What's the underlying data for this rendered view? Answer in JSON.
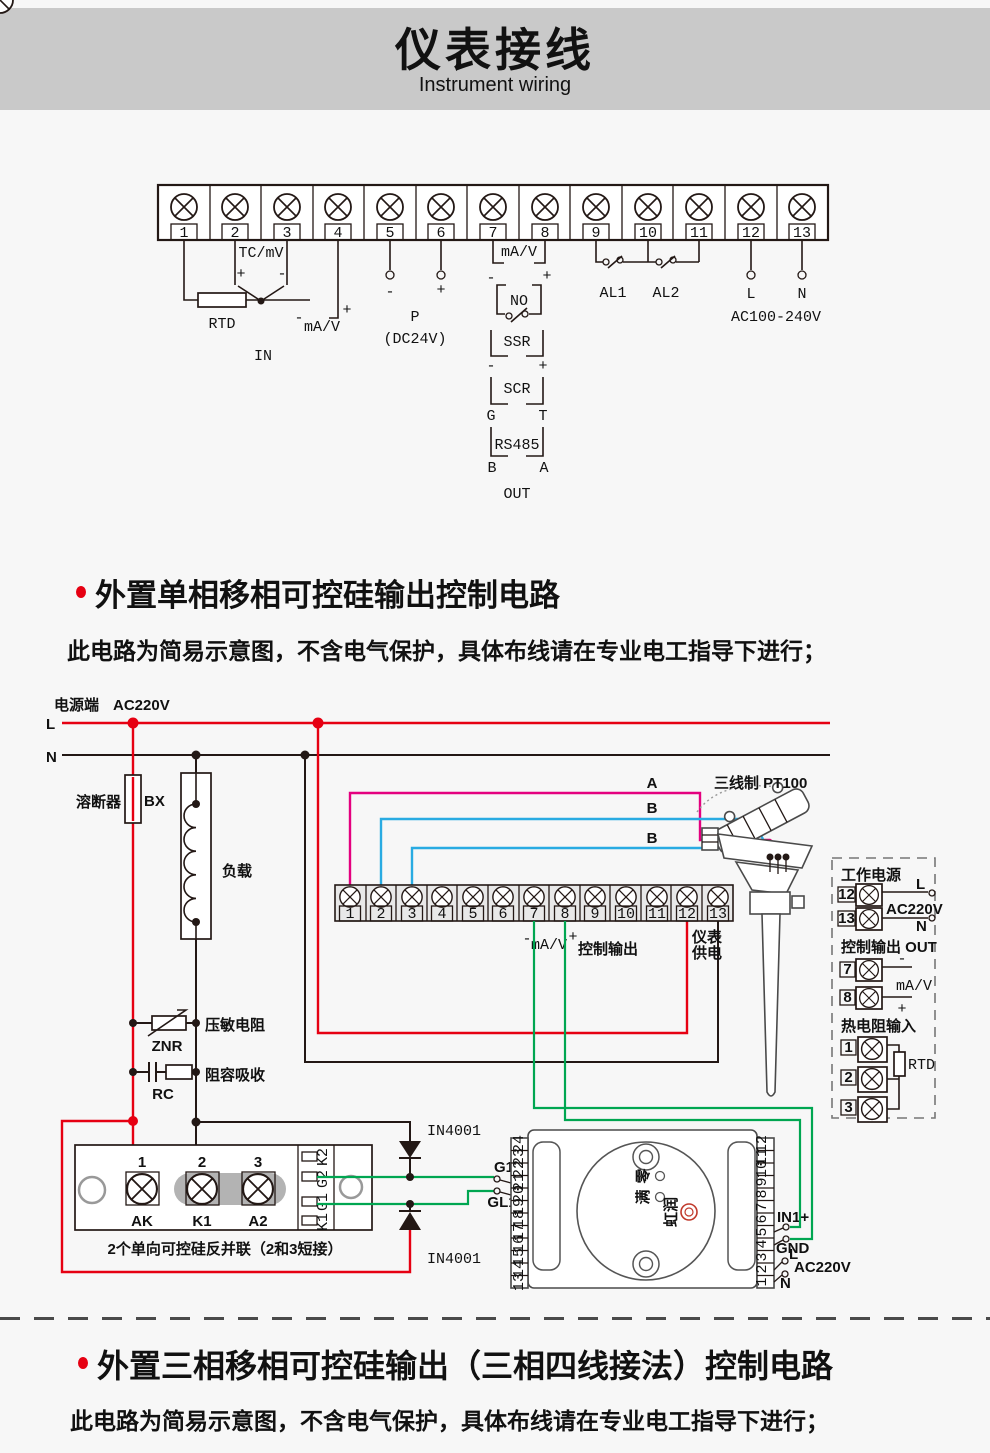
{
  "header": {
    "title": "仪表接线",
    "subtitle": "Instrument wiring"
  },
  "top_diagram": {
    "terminal_numbers": [
      "1",
      "2",
      "3",
      "4",
      "5",
      "6",
      "7",
      "8",
      "9",
      "10",
      "11",
      "12",
      "13"
    ],
    "rtd": "RTD",
    "tc": "TC/mV",
    "tc_plus": "+",
    "tc_minus": "-",
    "in_minus": "-",
    "in_mav": "mA/V",
    "in_plus": "+",
    "in": "IN",
    "p_minus": "-",
    "p_plus": "+",
    "p": "P",
    "p_volt": "(DC24V)",
    "out_mav": "mA/V",
    "out_minus": "-",
    "out_plus": "+",
    "no": "NO",
    "ssr": "SSR",
    "ssr_minus": "-",
    "ssr_plus": "+",
    "scr": "SCR",
    "scr_g": "G",
    "scr_t": "T",
    "rs485": "RS485",
    "rs485_b": "B",
    "rs485_a": "A",
    "out": "OUT",
    "al1": "AL1",
    "al2": "AL2",
    "l": "L",
    "n": "N",
    "mains": "AC100-240V"
  },
  "section1": {
    "title": "外置单相移相可控硅输出控制电路",
    "note": "此电路为简易示意图，不含电气保护，具体布线请在专业电工指导下进行；"
  },
  "circuit": {
    "source": "电源端",
    "source_voltage": "AC220V",
    "l": "L",
    "n": "N",
    "fuse": "溶断器",
    "fuse_code": "BX",
    "load": "负载",
    "varistor": "压敏电阻",
    "varistor_code": "ZNR",
    "snubber": "阻容吸收",
    "snubber_code": "RC",
    "sensor": "三线制 PT100",
    "wire_a": "A",
    "wire_b1": "B",
    "wire_b2": "B",
    "strip_numbers": [
      "1",
      "2",
      "3",
      "4",
      "5",
      "6",
      "7",
      "8",
      "9",
      "10",
      "11",
      "12",
      "13"
    ],
    "ctrl_minus": "-",
    "ctrl_mav": "mA/V",
    "ctrl_plus": "+",
    "ctrl_label": "控制输出",
    "supply1": "仪表",
    "supply2": "供电",
    "module": {
      "n1": "1",
      "n2": "2",
      "n3": "3",
      "ak": "AK",
      "k1": "K1",
      "a2": "A2",
      "pins": [
        "K2",
        "G2",
        "G1",
        "K1"
      ],
      "caption": "2个单向可控硅反并联（2和3短接）"
    },
    "diode_top": "IN4001",
    "diode_bottom": "IN4001",
    "g1": "G1",
    "gl1": "GL1",
    "meter": {
      "left_terminals": [
        "24",
        "23",
        "22",
        "21",
        "20",
        "19",
        "18",
        "17",
        "16",
        "15",
        "14",
        "13"
      ],
      "right_terminals": [
        "12",
        "11",
        "10",
        "9",
        "8",
        "7",
        "6",
        "5",
        "4",
        "3",
        "2",
        "1"
      ],
      "in1": "IN1+",
      "gnd": "GND",
      "l": "L",
      "n": "N",
      "mains": "AC220V",
      "adj1": "零",
      "adj2": "满",
      "brand": "虹润"
    },
    "panel": {
      "power_title": "工作电源",
      "t12": "12",
      "t13": "13",
      "l": "L",
      "mains": "AC220V",
      "n": "N",
      "out_title": "控制输出 OUT",
      "t7": "7",
      "t8": "8",
      "minus": "-",
      "mav": "mA/V",
      "plus": "+",
      "rtd_title": "热电阻输入",
      "t1": "1",
      "t2": "2",
      "t3": "3",
      "rtd": "RTD"
    }
  },
  "section2": {
    "title": "外置三相移相可控硅输出（三相四线接法）控制电路",
    "note": "此电路为简易示意图，不含电气保护，具体布线请在专业电工指导下进行；"
  },
  "colors": {
    "wire_red": "#e60012",
    "wire_green": "#00a651",
    "wire_pink": "#e4007f",
    "wire_blue": "#29abe2",
    "wire_black": "#231815"
  }
}
